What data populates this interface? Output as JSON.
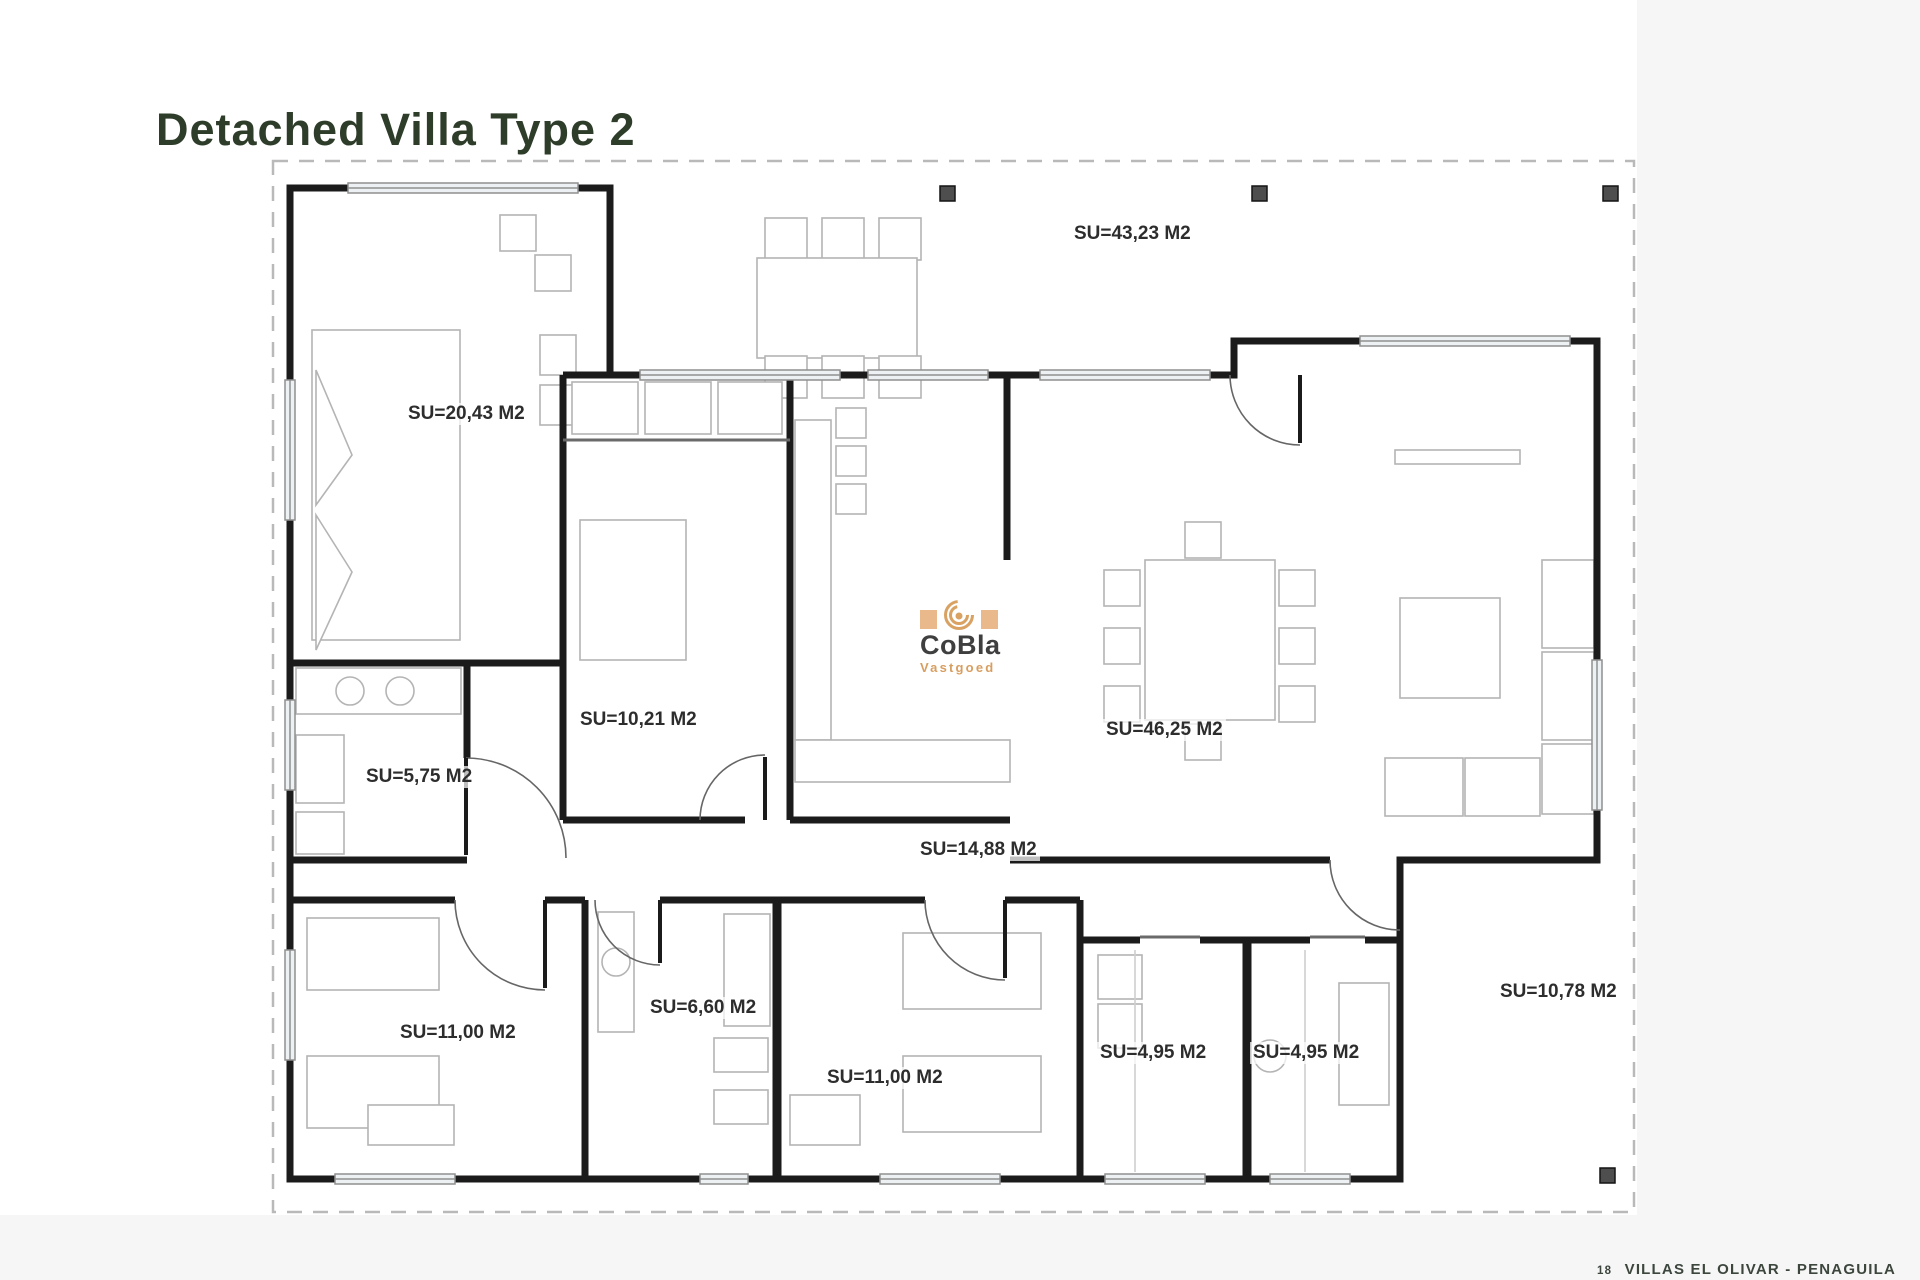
{
  "page": {
    "title": "Detached Villa Type 2"
  },
  "colors": {
    "title": "#2e3c2a",
    "room_label": "#2d2d2d",
    "watermark_accent": "#d89e60",
    "watermark_text": "#3f3f3f",
    "footer_text": "#3c463d",
    "walls": "#1b1b1b"
  },
  "icons": {
    "watermark": "spiral-icon"
  },
  "rooms": [
    {
      "name": "front-terrace",
      "label": "SU=43,23 M2"
    },
    {
      "name": "master-bedroom",
      "label": "SU=20,43 M2"
    },
    {
      "name": "bedroom-2",
      "label": "SU=10,21 M2"
    },
    {
      "name": "living-dining",
      "label": "SU=46,25 M2"
    },
    {
      "name": "laundry",
      "label": "SU=5,75 M2"
    },
    {
      "name": "kitchen-hall",
      "label": "SU=14,88 M2"
    },
    {
      "name": "bedroom-3",
      "label": "SU=11,00 M2"
    },
    {
      "name": "bathroom-1",
      "label": "SU=6,60 M2"
    },
    {
      "name": "bedroom-4",
      "label": "SU=11,00 M2"
    },
    {
      "name": "utility-room",
      "label": "SU=4,95 M2"
    },
    {
      "name": "bathroom-2",
      "label": "SU=4,95 M2"
    },
    {
      "name": "rear-terrace",
      "label": "SU=10,78 M2"
    }
  ],
  "watermark": {
    "brand": "CoBla",
    "subtitle": "Vastgoed"
  },
  "footer": {
    "page_number": "18",
    "text": "VILLAS EL OLIVAR - PENAGUILA"
  }
}
